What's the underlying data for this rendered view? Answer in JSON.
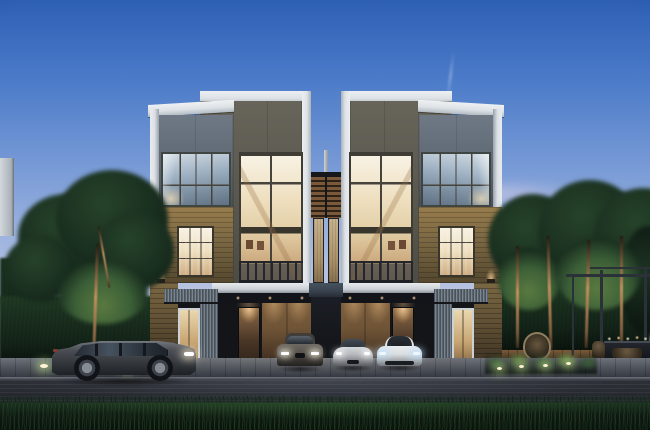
{
  "scene": {
    "type": "architectural-render",
    "time_of_day": "dusk",
    "description": "Modern three-storey mirrored duplex townhouses with white-framed grey and olive towers, brick bases, warm lit double-height windows, carport with three cars, grey SUV parked on street, landscaped trees, hedges and pergola dining garden",
    "objects": {
      "building": "mirrored duplex with two white-capped towers per unit",
      "left_unit": "grey tower with glass corner window over brick base, tall warm-lit stair window",
      "right_unit": "mirror image of left unit",
      "center": "recessed bay with timber louvre screen, curtained windows and bridge slab",
      "garage": "timber-clad carport with recessed downlights",
      "street": "paver sidewalk, asphalt road, grass verge foreground",
      "garden_right": "steel pergola with outdoor dining table, candles, rattan egg chair, uplit shrubs",
      "garden_left": "uplit trees, clipped hedge, ground lights",
      "background_left": "corner of neighbouring white building"
    },
    "cars": [
      {
        "name": "suv",
        "label": "grey SUV parked on street, side view",
        "color": "#4a4e53"
      },
      {
        "name": "sedan",
        "label": "grey-brown luxury sedan in carport, front view",
        "color": "#59554f"
      },
      {
        "name": "sports",
        "label": "silver sports coupe in carport, front view",
        "color": "#b4b8bc"
      },
      {
        "name": "hybrid",
        "label": "white hybrid sports car with blue lights in carport, front view",
        "color": "#d9dddf"
      }
    ],
    "lights": [
      "interior warm window glow",
      "garage downlights",
      "entry downlights",
      "brick wall sconces",
      "ground path lights",
      "shrub uplights",
      "table candles",
      "car headlights"
    ]
  },
  "palette": {
    "sky_top": "#2d5fb4",
    "sky_upper": "#4a7ac8",
    "sky_mid": "#7f9fd8",
    "sky_low": "#aebfe2",
    "sky_horizon": "#d6c9d4",
    "trim_white": "#dde2e6",
    "facade_gray": "#5e6873",
    "facade_gray_deep": "#49525c",
    "facade_olive": "#67655a",
    "facade_olive_deep": "#4d4c44",
    "brick": "#7a6743",
    "brick_deep": "#55482e",
    "brick_lit": "#977c4c",
    "mullion": "#45433b",
    "window_warm": "#eedfbf",
    "window_warm_bright": "#f8f2e4",
    "window_warm_deep": "#cfae83",
    "glass_cool": "#9eb1c3",
    "glass_cool_bright": "#d2dce4",
    "glass_cool_deep": "#5f7183",
    "slab_blue": "#3b4552",
    "louver_wood": "#7a583a",
    "curtain": "#c7b28c",
    "garage_wood": "#6e5336",
    "rail_dark": "#23262b",
    "deck_wood": "#5f4830",
    "pergola_steel": "#2a3139",
    "street": "#24272d",
    "sidewalk": "#565b64",
    "curb": "#70757e",
    "grass_dark": "#0a120c",
    "foliage_dark": "#16291c",
    "foliage_mid": "#26432a",
    "foliage_lit": "#3b5f37",
    "foliage_warm": "#5a7a40",
    "trunk_lit": "#c0905e",
    "light_warm": "#ffd9a0",
    "light_bright": "#fff3d6",
    "car_suv": "#4a4e53",
    "car_sedan": "#59554f",
    "car_silver": "#b4b8bc",
    "car_white": "#d9dddf",
    "bg_building": "#d3d8dd"
  }
}
